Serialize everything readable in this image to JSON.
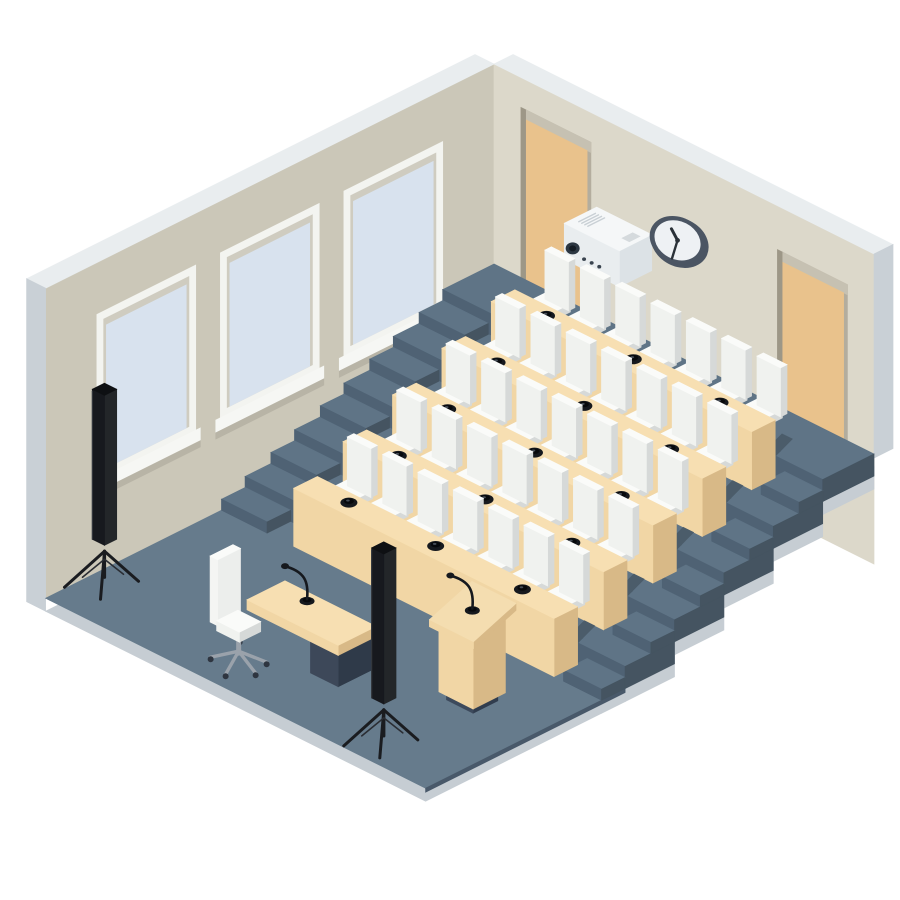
{
  "scene": {
    "subject": "isometric auditorium lecture hall illustration",
    "tier_count": 5,
    "desk_rows": 5,
    "chairs_per_row": 7,
    "mics_per_desk": 3,
    "windows": 3,
    "doors": 2,
    "speakers_on_tripods": 2,
    "has_projector": true,
    "has_wall_clock": true,
    "has_podium_with_mic": true,
    "has_teacher_desk_with_mic": true,
    "has_office_chair": true,
    "clock": {
      "hour_angle_deg": 305,
      "minute_angle_deg": 170
    }
  },
  "colors": {
    "background": "#ffffff",
    "wall_left": "#cbc7b8",
    "wall_right": "#dcd8ca",
    "wall_top": "#e9edef",
    "wall_outer": "#c9d0d6",
    "window_frame": "#f3f4f0",
    "window_inner_shadow": "#cfccc0",
    "window_glass": "#d8e2ee",
    "window_sill": "#f6f7f4",
    "window_sill_shadow": "#b8b4a6",
    "door_recess": "#b3ad9e",
    "door_jamb": "#9d9787",
    "door_lintel": "#c6c1b2",
    "door": "#e9c28c",
    "floor": "#667b8c",
    "tier_top": "#5f7486",
    "riser": "#4f6274",
    "cut_face": "#455461",
    "slab_edge": "#c6cdd3",
    "floor_edge_dark": "#49596a",
    "shadow": "#4b5c6a",
    "desk_top": "#f7dfb2",
    "desk_front": "#f1d6a5",
    "desk_side": "#d8b987",
    "chair_top": "#fafbf9",
    "chair_front": "#f0f2ef",
    "chair_side": "#d6d9d8",
    "chair_base": "#3d4a5c",
    "chair_base_dark": "#313d4e",
    "mic": "#16191e",
    "mic_dark": "#07090c",
    "teacher_body_front": "#3d4859",
    "teacher_body_side": "#2f3a49",
    "metal": "#9aa2ab",
    "wheel": "#2e3540",
    "speaker_front": "#17191e",
    "speaker_side": "#232629",
    "speaker_top": "#0e1013",
    "stand": "#1a1c20",
    "projector_top": "#f5f7f8",
    "projector_front": "#e9edef",
    "projector_side": "#dce2e6",
    "projector_detail": "#c9d0d5",
    "projector_label": "#d5dadd",
    "projector_dark": "#2c3742",
    "clock_rim": "#4b5563",
    "clock_face": "#eef1f4",
    "clock_hand": "#2a3138"
  }
}
